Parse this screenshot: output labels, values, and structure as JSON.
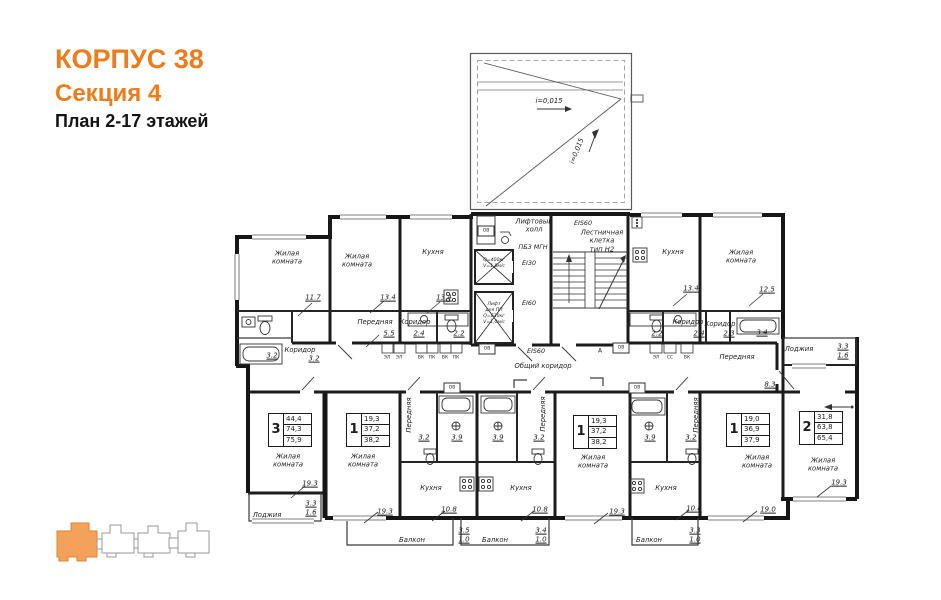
{
  "header": {
    "building": "КОРПУС 38",
    "section": "Секция 4",
    "floors": "План 2-17 этажей"
  },
  "roof": {
    "slope_right": "i=0,015",
    "slope_up": "i=0,015"
  },
  "core": {
    "lift_hall": "Лифтовый\nхолл",
    "pbz": "ПБЗ МГН",
    "ei30": "EI30",
    "ei60": "EI60",
    "eis60_top": "EIS60",
    "eis60_bottom": "EIS60",
    "stair_label": "Лестничная\nклетка\nтип Н2",
    "lift_small": "Q=400кг\nV=1,0м/с",
    "lift_big": "Лифт\nдля ПП\nQ=630кг\nV=1,0м/с",
    "axis": "А",
    "ov": "ОВ",
    "common_corridor": "Общий коридор",
    "shafts_left": [
      "ЭЛ",
      "ЭЛ",
      "ВК",
      "ПК",
      "ВК",
      "ПК"
    ],
    "shafts_right": [
      "ЭЛ",
      "СС",
      "ВК"
    ]
  },
  "upper_left": {
    "room1": {
      "name": "Жилая\nкомната",
      "area": "11.7"
    },
    "room2": {
      "name": "Жилая\nкомната",
      "area": "13.4"
    },
    "kitchen": {
      "name": "Кухня",
      "area": "13.4"
    },
    "hall": {
      "name": "Передняя",
      "area": "5.5"
    },
    "corridor1": {
      "name": "Коридор",
      "area": "2.4"
    },
    "wc_area": "2.2",
    "corridor2": {
      "name": "Коридор",
      "area": "3.2"
    },
    "bath_area": "3.2"
  },
  "upper_right": {
    "kitchen": {
      "name": "Кухня",
      "area": "13.4"
    },
    "room": {
      "name": "Жилая\nкомната",
      "area": "12.5"
    },
    "wc_area": "2.2",
    "corridor1": {
      "name": "Коридор",
      "area": "2.4"
    },
    "corridor2": {
      "name": "Коридор",
      "area": "2.3"
    },
    "bath_area": "3.4",
    "loggia": {
      "name": "Лоджия",
      "area": "3.3",
      "reduced": "1.6"
    },
    "hall": {
      "name": "Передняя",
      "area": "8.3"
    }
  },
  "apartments": [
    {
      "num": "3",
      "rows": [
        "44,4",
        "74,3",
        "75,9"
      ]
    },
    {
      "num": "1",
      "rows": [
        "19,3",
        "37,2",
        "38,2"
      ]
    },
    {
      "num": "1",
      "rows": [
        "19,3",
        "37,2",
        "38,2"
      ]
    },
    {
      "num": "1",
      "rows": [
        "19,0",
        "36,9",
        "37,9"
      ]
    },
    {
      "num": "2",
      "rows": [
        "31,8",
        "63,8",
        "65,4"
      ]
    }
  ],
  "lower": {
    "apt3_room": {
      "name": "Жилая\nкомната",
      "area": "19.3"
    },
    "apt3_loggia": {
      "name": "Лоджия",
      "area": "3.3",
      "reduced": "1.6"
    },
    "apt1l_room": {
      "name": "Жилая\nкомната",
      "area": "19.3"
    },
    "apt1l_hall": {
      "name": "Передняя",
      "area": "3.2"
    },
    "apt1l_bath": "3.9",
    "apt1l_kitchen": {
      "name": "Кухня",
      "area": "10.8"
    },
    "balcony1": {
      "name": "Балкон",
      "area": "3.5",
      "reduced": "1.0"
    },
    "apt1c_room": {
      "name": "Жилая\nкомната",
      "area": "19.3"
    },
    "apt1c_hall": {
      "name": "Передняя",
      "area": "3.2"
    },
    "apt1c_bath": "3.9",
    "apt1c_kitchen": {
      "name": "Кухня",
      "area": "10.8"
    },
    "balcony2": {
      "name": "Балкон",
      "area": "3.4",
      "reduced": "1.0"
    },
    "apt1r_room": {
      "name": "Жилая\nкомната",
      "area": "19.0"
    },
    "apt1r_hall": {
      "name": "Передняя",
      "area": "3.2"
    },
    "apt1r_bath": "3.9",
    "apt1r_kitchen": {
      "name": "Кухня",
      "area": "10.8"
    },
    "balcony3": {
      "name": "Балкон",
      "area": "3.3",
      "reduced": "1.0"
    },
    "apt2_room": {
      "name": "Жилая\nкомната",
      "area": "19.3"
    }
  },
  "colors": {
    "accent": "#ee7c1a",
    "keyplan_highlight": "#f4a259"
  }
}
